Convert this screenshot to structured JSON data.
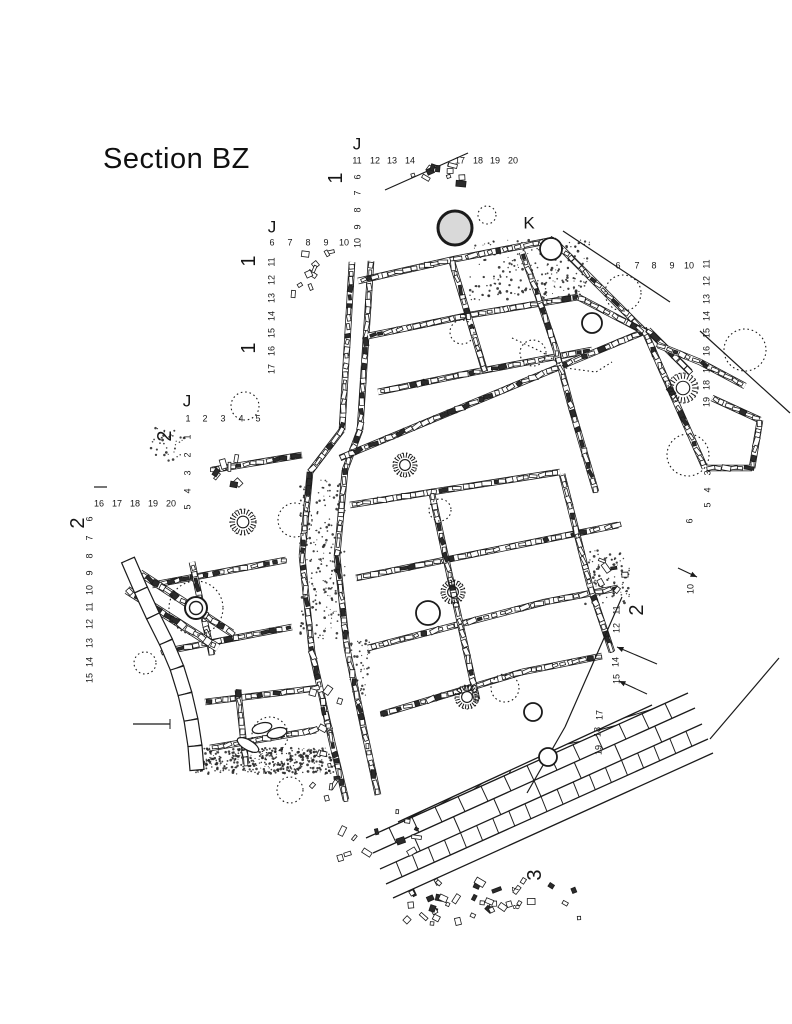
{
  "title": "Section BZ",
  "plan": {
    "grid_letters": [
      "J",
      "J",
      "J",
      "K"
    ],
    "section_lines": [
      "1",
      "2",
      "3"
    ],
    "labels": [
      {
        "t": "J",
        "x": 357,
        "y": 144,
        "r": false,
        "k": "letter"
      },
      {
        "t": "J",
        "x": 272,
        "y": 227,
        "r": false,
        "k": "letter"
      },
      {
        "t": "J",
        "x": 187,
        "y": 401,
        "r": false,
        "k": "letter"
      },
      {
        "t": "K",
        "x": 529,
        "y": 223,
        "r": false,
        "k": "letter"
      },
      {
        "t": "1",
        "x": 336,
        "y": 178,
        "r": true,
        "k": "section"
      },
      {
        "t": "1",
        "x": 249,
        "y": 261,
        "r": true,
        "k": "section"
      },
      {
        "t": "1",
        "x": 249,
        "y": 348,
        "r": true,
        "k": "section"
      },
      {
        "t": "2",
        "x": 165,
        "y": 436,
        "r": true,
        "k": "section"
      },
      {
        "t": "2",
        "x": 78,
        "y": 523,
        "r": true,
        "k": "section"
      },
      {
        "t": "2",
        "x": 637,
        "y": 610,
        "r": true,
        "k": "section"
      },
      {
        "t": "3",
        "x": 535,
        "y": 875,
        "r": true,
        "k": "section"
      },
      {
        "t": "11",
        "x": 357,
        "y": 161,
        "r": false,
        "k": "number"
      },
      {
        "t": "12",
        "x": 375,
        "y": 161,
        "r": false,
        "k": "number"
      },
      {
        "t": "13",
        "x": 392,
        "y": 161,
        "r": false,
        "k": "number"
      },
      {
        "t": "14",
        "x": 410,
        "y": 161,
        "r": false,
        "k": "number"
      },
      {
        "t": "17",
        "x": 460,
        "y": 161,
        "r": false,
        "k": "number"
      },
      {
        "t": "18",
        "x": 478,
        "y": 161,
        "r": false,
        "k": "number"
      },
      {
        "t": "19",
        "x": 495,
        "y": 161,
        "r": false,
        "k": "number"
      },
      {
        "t": "20",
        "x": 513,
        "y": 161,
        "r": false,
        "k": "number"
      },
      {
        "t": "6",
        "x": 272,
        "y": 243,
        "r": false,
        "k": "number"
      },
      {
        "t": "7",
        "x": 290,
        "y": 243,
        "r": false,
        "k": "number"
      },
      {
        "t": "8",
        "x": 308,
        "y": 243,
        "r": false,
        "k": "number"
      },
      {
        "t": "9",
        "x": 326,
        "y": 243,
        "r": false,
        "k": "number"
      },
      {
        "t": "10",
        "x": 344,
        "y": 243,
        "r": false,
        "k": "number"
      },
      {
        "t": "1",
        "x": 188,
        "y": 419,
        "r": false,
        "k": "number"
      },
      {
        "t": "2",
        "x": 205,
        "y": 419,
        "r": false,
        "k": "number"
      },
      {
        "t": "3",
        "x": 223,
        "y": 419,
        "r": false,
        "k": "number"
      },
      {
        "t": "4",
        "x": 241,
        "y": 419,
        "r": false,
        "k": "number"
      },
      {
        "t": "5",
        "x": 258,
        "y": 419,
        "r": false,
        "k": "number"
      },
      {
        "t": "16",
        "x": 99,
        "y": 504,
        "r": false,
        "k": "number"
      },
      {
        "t": "17",
        "x": 117,
        "y": 504,
        "r": false,
        "k": "number"
      },
      {
        "t": "18",
        "x": 135,
        "y": 504,
        "r": false,
        "k": "number"
      },
      {
        "t": "19",
        "x": 153,
        "y": 504,
        "r": false,
        "k": "number"
      },
      {
        "t": "20",
        "x": 171,
        "y": 504,
        "r": false,
        "k": "number"
      },
      {
        "t": "6",
        "x": 618,
        "y": 266,
        "r": false,
        "k": "number"
      },
      {
        "t": "7",
        "x": 637,
        "y": 266,
        "r": false,
        "k": "number"
      },
      {
        "t": "8",
        "x": 654,
        "y": 266,
        "r": false,
        "k": "number"
      },
      {
        "t": "9",
        "x": 672,
        "y": 266,
        "r": false,
        "k": "number"
      },
      {
        "t": "10",
        "x": 689,
        "y": 266,
        "r": false,
        "k": "number"
      },
      {
        "t": "6",
        "x": 358,
        "y": 177,
        "r": true,
        "k": "number"
      },
      {
        "t": "7",
        "x": 358,
        "y": 193,
        "r": true,
        "k": "number"
      },
      {
        "t": "8",
        "x": 358,
        "y": 210,
        "r": true,
        "k": "number"
      },
      {
        "t": "9",
        "x": 358,
        "y": 227,
        "r": true,
        "k": "number"
      },
      {
        "t": "10",
        "x": 358,
        "y": 243,
        "r": true,
        "k": "number"
      },
      {
        "t": "11",
        "x": 272,
        "y": 262,
        "r": true,
        "k": "number"
      },
      {
        "t": "12",
        "x": 272,
        "y": 280,
        "r": true,
        "k": "number"
      },
      {
        "t": "13",
        "x": 272,
        "y": 298,
        "r": true,
        "k": "number"
      },
      {
        "t": "14",
        "x": 272,
        "y": 316,
        "r": true,
        "k": "number"
      },
      {
        "t": "15",
        "x": 272,
        "y": 333,
        "r": true,
        "k": "number"
      },
      {
        "t": "16",
        "x": 272,
        "y": 351,
        "r": true,
        "k": "number"
      },
      {
        "t": "17",
        "x": 272,
        "y": 369,
        "r": true,
        "k": "number"
      },
      {
        "t": "1",
        "x": 188,
        "y": 437,
        "r": true,
        "k": "number"
      },
      {
        "t": "2",
        "x": 188,
        "y": 455,
        "r": true,
        "k": "number"
      },
      {
        "t": "3",
        "x": 188,
        "y": 473,
        "r": true,
        "k": "number"
      },
      {
        "t": "4",
        "x": 188,
        "y": 491,
        "r": true,
        "k": "number"
      },
      {
        "t": "5",
        "x": 188,
        "y": 507,
        "r": true,
        "k": "number"
      },
      {
        "t": "6",
        "x": 90,
        "y": 519,
        "r": true,
        "k": "number"
      },
      {
        "t": "7",
        "x": 90,
        "y": 538,
        "r": true,
        "k": "number"
      },
      {
        "t": "8",
        "x": 90,
        "y": 556,
        "r": true,
        "k": "number"
      },
      {
        "t": "9",
        "x": 90,
        "y": 573,
        "r": true,
        "k": "number"
      },
      {
        "t": "10",
        "x": 90,
        "y": 590,
        "r": true,
        "k": "number"
      },
      {
        "t": "11",
        "x": 90,
        "y": 607,
        "r": true,
        "k": "number"
      },
      {
        "t": "12",
        "x": 90,
        "y": 624,
        "r": true,
        "k": "number"
      },
      {
        "t": "13",
        "x": 90,
        "y": 643,
        "r": true,
        "k": "number"
      },
      {
        "t": "14",
        "x": 90,
        "y": 662,
        "r": true,
        "k": "number"
      },
      {
        "t": "15",
        "x": 90,
        "y": 678,
        "r": true,
        "k": "number"
      },
      {
        "t": "11",
        "x": 707,
        "y": 264,
        "r": true,
        "k": "number"
      },
      {
        "t": "12",
        "x": 707,
        "y": 281,
        "r": true,
        "k": "number"
      },
      {
        "t": "13",
        "x": 707,
        "y": 299,
        "r": true,
        "k": "number"
      },
      {
        "t": "14",
        "x": 707,
        "y": 316,
        "r": true,
        "k": "number"
      },
      {
        "t": "15",
        "x": 707,
        "y": 333,
        "r": true,
        "k": "number"
      },
      {
        "t": "16",
        "x": 707,
        "y": 351,
        "r": true,
        "k": "number"
      },
      {
        "t": "17",
        "x": 707,
        "y": 368,
        "r": true,
        "k": "number"
      },
      {
        "t": "18",
        "x": 707,
        "y": 385,
        "r": true,
        "k": "number"
      },
      {
        "t": "19",
        "x": 707,
        "y": 402,
        "r": true,
        "k": "number"
      },
      {
        "t": "3",
        "x": 708,
        "y": 473,
        "r": true,
        "k": "number"
      },
      {
        "t": "4",
        "x": 708,
        "y": 490,
        "r": true,
        "k": "number"
      },
      {
        "t": "5",
        "x": 708,
        "y": 505,
        "r": true,
        "k": "number"
      },
      {
        "t": "6",
        "x": 690,
        "y": 521,
        "r": true,
        "k": "number"
      },
      {
        "t": "10",
        "x": 691,
        "y": 589,
        "r": true,
        "k": "number"
      },
      {
        "t": "11",
        "x": 617,
        "y": 610,
        "r": true,
        "k": "number"
      },
      {
        "t": "12",
        "x": 617,
        "y": 628,
        "r": true,
        "k": "number"
      },
      {
        "t": "14",
        "x": 616,
        "y": 662,
        "r": true,
        "k": "number"
      },
      {
        "t": "15",
        "x": 617,
        "y": 679,
        "r": true,
        "k": "number"
      },
      {
        "t": "17",
        "x": 600,
        "y": 715,
        "r": true,
        "k": "number"
      },
      {
        "t": "18",
        "x": 598,
        "y": 732,
        "r": true,
        "k": "number"
      },
      {
        "t": "19",
        "x": 599,
        "y": 750,
        "r": true,
        "k": "number"
      },
      {
        "t": "7",
        "x": 516,
        "y": 889,
        "r": true,
        "k": "number"
      },
      {
        "t": "8",
        "x": 517,
        "y": 907,
        "r": true,
        "k": "number"
      }
    ]
  }
}
